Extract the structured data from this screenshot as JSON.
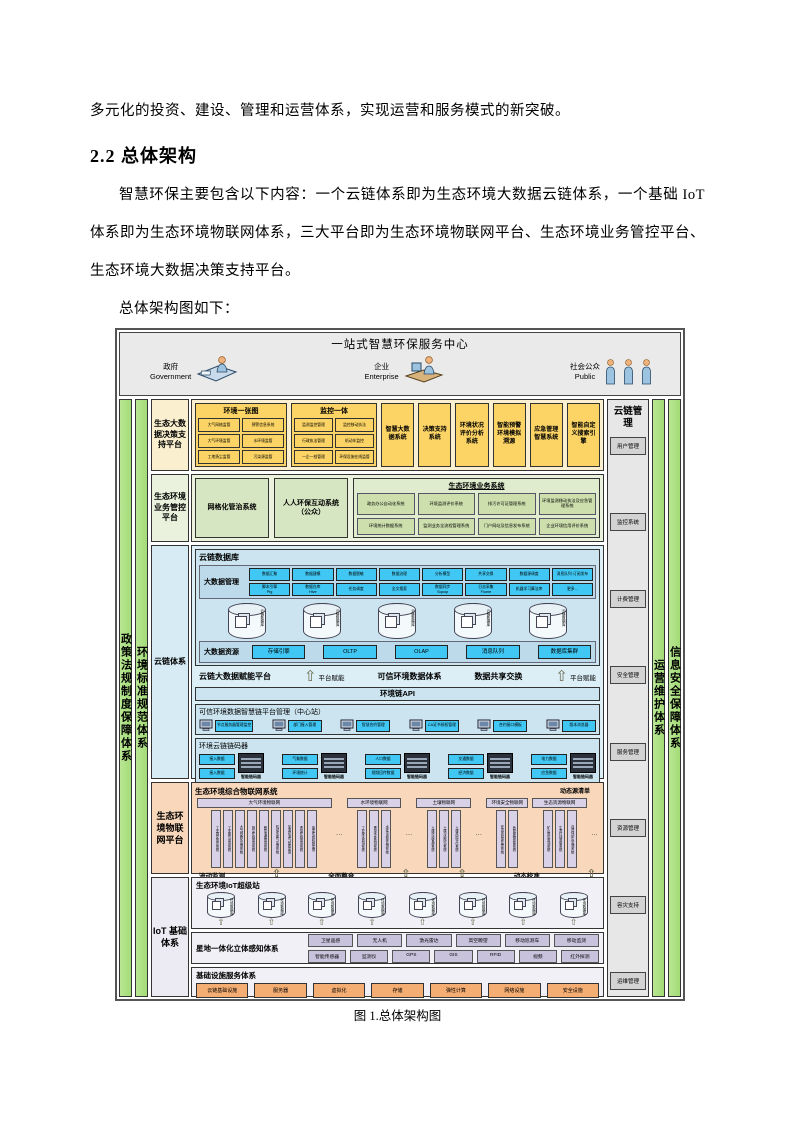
{
  "doc": {
    "para_top": "多元化的投资、建设、管理和运营体系，实现运营和服务模式的新突破。",
    "heading": "2.2 总体架构",
    "para_body": "智慧环保主要包含以下内容：一个云链体系即为生态环境大数据云链体系，一个基础 IoT 体系即为生态环境物联网体系，三大平台即为生态环境物联网平台、生态环境业务管控平台、生态环境大数据决策支持平台。",
    "para_lead": "总体架构图如下：",
    "figure_caption": "图 1.总体架构图"
  },
  "diagram": {
    "header": {
      "title": "一站式智慧环保服务中心",
      "actors": [
        {
          "zh": "政府",
          "en": "Government"
        },
        {
          "zh": "企业",
          "en": "Enterprise"
        },
        {
          "zh": "社会公众",
          "en": "Public"
        }
      ]
    },
    "left_bars": [
      "政策法规制度保障体系",
      "环境标准规范体系"
    ],
    "right_bars": [
      "运营维护体系",
      "信息安全保障体系"
    ],
    "cloud_mgmt": {
      "title": "云链管理",
      "items": [
        "用户管理",
        "监控系统",
        "计费管理",
        "安全管理",
        "服务管理",
        "资源管理",
        "容灾支持",
        "运维管理"
      ]
    },
    "decision": {
      "label": "生态大数据决策支持平台",
      "map_group": {
        "title": "环境一张图",
        "items": [
          "大气网格监管",
          "预警信息系统",
          "大气环境监管",
          "水环境监管",
          "工地扬尘监管",
          "污染源监管"
        ]
      },
      "monitor_group": {
        "title": "监控一体",
        "items": [
          "监测监控管理",
          "监控移动执法",
          "行政执法管理",
          "机动车监控",
          "一企一档管理",
          "环保设施在线监管"
        ]
      },
      "systems": [
        "智慧大数据系统",
        "决策支持系统",
        "环境状况评价分析系统",
        "智能预警环境模拟溯源",
        "应急管理智慧系统",
        "智能自定义搜索引擎"
      ]
    },
    "business": {
      "label": "生态环境业务管控平台",
      "grid_box": "网格化管治系统",
      "public_box": "人人环保互动系统（公众）",
      "biz_group": {
        "title": "生态环境业务系统",
        "items": [
          "政务办公自动化系统",
          "环境监测评价系统",
          "排污许可证管理系统",
          "环境监测移动执法及应急管理系统",
          "环境统计数据系统",
          "监测业务全流程管理系统",
          "门户网站及信息发布系统",
          "企业环境信用评价系统"
        ]
      }
    },
    "cloudchain": {
      "label": "云链体系",
      "db": {
        "title": "云链数据库",
        "mgmt_label": "大数据管理",
        "row1": [
          "数据汇聚",
          "数据建模",
          "数据脱敏",
          "数据治理",
          "分析模型",
          "共享交换",
          "数据源调度",
          "消息队列·订阅发布"
        ],
        "row2": [
          "脚本引擎\nPig",
          "数据仓库\nHive",
          "任务调度",
          "全文搜索",
          "数据同步\nSqoop",
          "日志采集\nFlume",
          "机器学习算法库",
          "更多..."
        ],
        "cyl_label": "云链数据库",
        "resource_label": "大数据资源",
        "resources": [
          "存储引擎",
          "OLTP",
          "OLAP",
          "消息队列",
          "数据库集群"
        ]
      },
      "empower": {
        "left": "云链大数据赋能平台",
        "mid": "可信环境数据体系",
        "right": "数据共享交换",
        "arrow_label": "平台赋能"
      },
      "api_bar": "环境链API",
      "trust": {
        "title": "可信环境数据智慧链平台管理（中心站）",
        "terminals": [
          "节点服务器管理监控",
          "部门接入管理",
          "智慧合约管理",
          "CA证书授权管理",
          "合约接口模板",
          "版本浏览器"
        ]
      },
      "chaincode": {
        "title": "环境云链链码器",
        "server_label": "智能链码器",
        "groups": [
          {
            "inputs": [
              "接入数据",
              "接入数据"
            ]
          },
          {
            "inputs": [
              "气象数据",
              "环境统计"
            ]
          },
          {
            "inputs": [
              "人口数据",
              "视频回传数据"
            ]
          },
          {
            "inputs": [
              "交通数据",
              "经济数据"
            ]
          },
          {
            "inputs": [
              "电力数据",
              "应急数据"
            ]
          }
        ]
      }
    },
    "iot_platform": {
      "label": "生态环境物联网平台",
      "title": "生态环境综合物联网系统",
      "note": "动态源清单",
      "ellipsis": "…",
      "groups": [
        {
          "title": "大气环境物联网",
          "boxes": [
            "工业园区监控系统",
            "工业废气监测系统",
            "大气网格化监测系统",
            "扬尘在线监测系统",
            "餐饮油烟监测系统",
            "机动车尾气监测系统",
            "加油站油气回收监测",
            "恶臭在线监测系统",
            "挥发性有机物监测"
          ]
        },
        {
          "title": "水环境物联网",
          "boxes": [
            "工业废水监测系统",
            "黑臭水体监测系统",
            "水环境质量监测系统"
          ]
        },
        {
          "title": "土壤物联网",
          "boxes": [
            "土壤环境管理系统",
            "土壤污染防治系统",
            "土壤风险评估系统"
          ]
        },
        {
          "title": "环境安全物联网",
          "boxes": [
            "环境风险源监控系统",
            "危险废物监管系统"
          ]
        },
        {
          "title": "生态资源物联网",
          "boxes": [
            "矿山恢复监测系统",
            "生态红线监管系统",
            "自然保护区监测系统"
          ]
        }
      ],
      "bottom_labels": [
        "流动监测",
        "全面整合",
        "动态校准"
      ]
    },
    "iot_base": {
      "label": "IoT 基础体系",
      "superstation": {
        "title": "生态环境IoT超级站",
        "cyl_label": "环境数据库"
      },
      "sensing": {
        "title": "星地一体化立体感知体系",
        "row1": [
          "卫星遥感",
          "无人机",
          "激光雷达",
          "高空瞭望",
          "移动巡测车",
          "移动监测"
        ],
        "row2": [
          "智能传感器",
          "监测仪",
          "GPS",
          "GIS",
          "RFID",
          "视频",
          "红外探测"
        ]
      },
      "infra": {
        "title": "基础设施服务体系",
        "items": [
          "云链基础设施",
          "服务器",
          "虚拟化",
          "存储",
          "弹性计算",
          "网络设施",
          "安全设施"
        ]
      }
    }
  }
}
